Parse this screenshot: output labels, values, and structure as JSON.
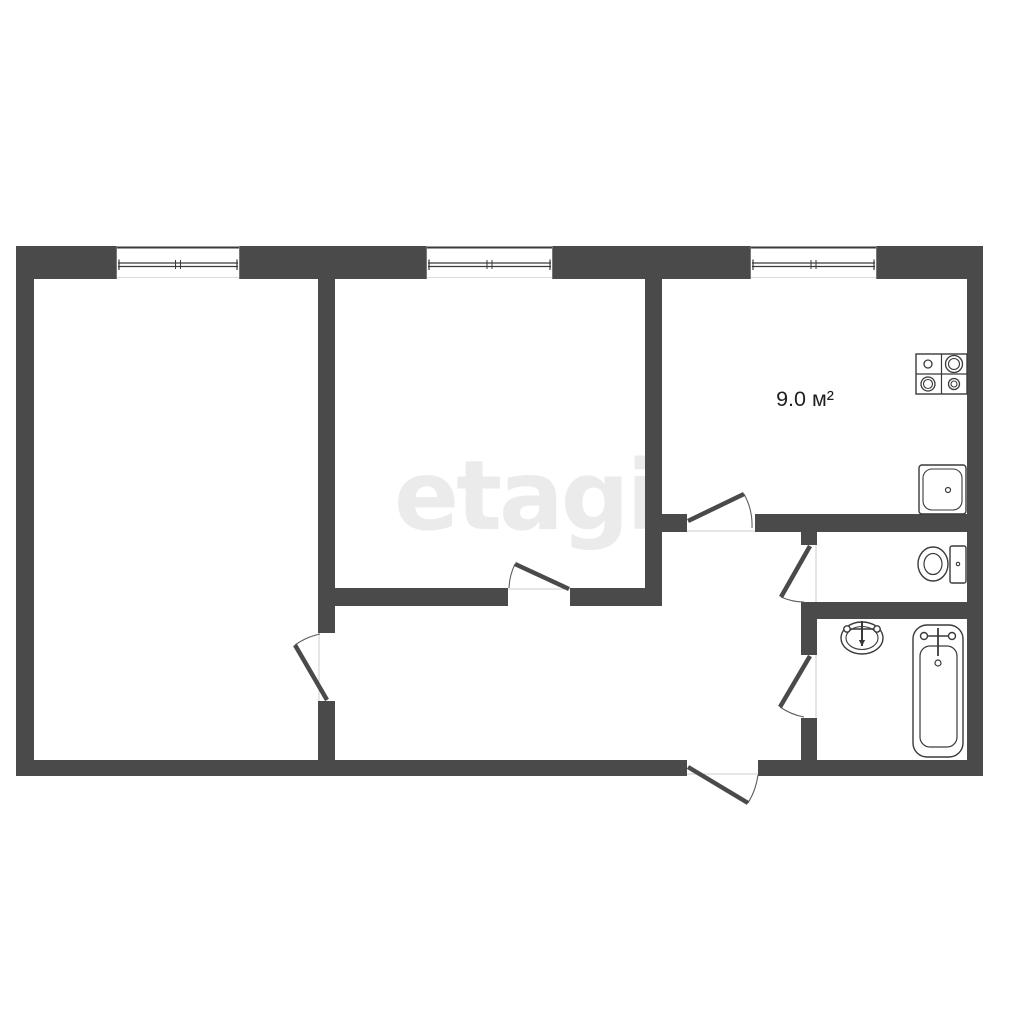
{
  "canvas": {
    "width": 1024,
    "height": 1024,
    "background": "#ffffff"
  },
  "colors": {
    "wall": "#4a4a4a",
    "door_leaf": "#4a4a4a",
    "door_arc": "#5f5f5f",
    "threshold": "#cccccc",
    "window_line": "#3a3a3a",
    "window_jamb": "#777777",
    "window_faint": "#dcdcdc",
    "fixture_stroke": "#3a3a3a",
    "fixture_fill": "#ffffff",
    "label_text": "#1f1f1f",
    "watermark": "#ebebeb"
  },
  "watermark": {
    "text": "etagi"
  },
  "labels": [
    {
      "name": "kitchen-area-label",
      "text": "9.0 м²",
      "x": 805,
      "y": 406,
      "font_size": 21.5
    }
  ],
  "walls": [
    {
      "name": "outer-top-wall-seg1",
      "x": 16,
      "y": 246,
      "w": 100,
      "h": 33
    },
    {
      "name": "outer-top-wall-seg2",
      "x": 240,
      "y": 246,
      "w": 186,
      "h": 33
    },
    {
      "name": "outer-top-wall-seg3",
      "x": 553,
      "y": 246,
      "w": 197,
      "h": 33
    },
    {
      "name": "outer-top-wall-seg4",
      "x": 877,
      "y": 246,
      "w": 106,
      "h": 33
    },
    {
      "name": "outer-left-wall",
      "x": 16,
      "y": 246,
      "w": 18,
      "h": 530
    },
    {
      "name": "outer-right-wall",
      "x": 967,
      "y": 246,
      "w": 16,
      "h": 530
    },
    {
      "name": "outer-bottom-wall-seg1",
      "x": 16,
      "y": 760,
      "w": 671,
      "h": 16
    },
    {
      "name": "outer-bottom-wall-seg2",
      "x": 758,
      "y": 760,
      "w": 225,
      "h": 16
    },
    {
      "name": "wall-left-room-right-seg1",
      "x": 318,
      "y": 279,
      "w": 17,
      "h": 354
    },
    {
      "name": "wall-left-room-right-seg2",
      "x": 318,
      "y": 701,
      "w": 17,
      "h": 59
    },
    {
      "name": "wall-middle-room-kitchen",
      "x": 645,
      "y": 279,
      "w": 17,
      "h": 327
    },
    {
      "name": "wall-middle-room-bottom-seg1",
      "x": 335,
      "y": 588,
      "w": 173,
      "h": 18
    },
    {
      "name": "wall-middle-room-bottom-seg2",
      "x": 570,
      "y": 588,
      "w": 75,
      "h": 18
    },
    {
      "name": "wall-kitchen-bottom-seg1",
      "x": 662,
      "y": 514,
      "w": 25,
      "h": 18
    },
    {
      "name": "wall-kitchen-bottom-seg2",
      "x": 755,
      "y": 514,
      "w": 212,
      "h": 18
    },
    {
      "name": "wall-sanitary-left-seg1",
      "x": 801,
      "y": 532,
      "w": 16,
      "h": 13
    },
    {
      "name": "wall-sanitary-left-seg2",
      "x": 801,
      "y": 602,
      "w": 16,
      "h": 53
    },
    {
      "name": "wall-sanitary-left-seg3",
      "x": 801,
      "y": 718,
      "w": 16,
      "h": 42
    },
    {
      "name": "wall-wc-bathroom",
      "x": 801,
      "y": 602,
      "w": 166,
      "h": 17
    }
  ],
  "windows": [
    {
      "name": "window-left-room",
      "x": 116,
      "y": 246,
      "w": 124,
      "h": 33
    },
    {
      "name": "window-middle-room",
      "x": 426,
      "y": 246,
      "w": 127,
      "h": 33
    },
    {
      "name": "window-kitchen",
      "x": 750,
      "y": 246,
      "w": 127,
      "h": 33
    }
  ],
  "doors": [
    {
      "name": "door-left-room",
      "hinge": [
        327,
        700
      ],
      "tip": [
        295,
        645
      ],
      "arc_end": [
        320,
        634
      ],
      "sweep": 1
    },
    {
      "name": "door-middle-room",
      "hinge": [
        569,
        589
      ],
      "tip": [
        515,
        564
      ],
      "arc_end": [
        509,
        588
      ],
      "sweep": 0
    },
    {
      "name": "door-kitchen",
      "hinge": [
        688,
        521
      ],
      "tip": [
        744,
        494
      ],
      "arc_end": [
        752,
        528
      ],
      "sweep": 1
    },
    {
      "name": "door-wc",
      "hinge": [
        810,
        546
      ],
      "tip": [
        781,
        597
      ],
      "arc_end": [
        804,
        602
      ],
      "sweep": 0
    },
    {
      "name": "door-bathroom",
      "hinge": [
        810,
        656
      ],
      "tip": [
        780,
        707
      ],
      "arc_end": [
        804,
        717
      ],
      "sweep": 0
    },
    {
      "name": "door-entrance",
      "hinge": [
        688,
        767
      ],
      "tip": [
        748,
        803
      ],
      "arc_end": [
        758,
        775
      ],
      "sweep": 0
    }
  ],
  "thresholds": [
    {
      "name": "threshold-left-room",
      "x1": 319,
      "y1": 633,
      "x2": 319,
      "y2": 701
    },
    {
      "name": "threshold-middle-room",
      "x1": 508,
      "y1": 589,
      "x2": 570,
      "y2": 589
    },
    {
      "name": "threshold-kitchen",
      "x1": 687,
      "y1": 531,
      "x2": 755,
      "y2": 531
    },
    {
      "name": "threshold-wc",
      "x1": 816,
      "y1": 545,
      "x2": 816,
      "y2": 602
    },
    {
      "name": "threshold-bathroom",
      "x1": 816,
      "y1": 655,
      "x2": 816,
      "y2": 718
    },
    {
      "name": "threshold-entrance",
      "x1": 687,
      "y1": 774,
      "x2": 758,
      "y2": 774
    }
  ],
  "fixtures": {
    "stove": {
      "name": "stove-icon",
      "x": 916,
      "y": 354,
      "w": 51,
      "h": 40,
      "burners": [
        {
          "cx": 928,
          "cy": 364,
          "r": 4
        },
        {
          "cx": 954,
          "cy": 364,
          "r": 8.5,
          "r2": 5.5
        },
        {
          "cx": 928,
          "cy": 384,
          "r": 7,
          "r2": 4.5
        },
        {
          "cx": 954,
          "cy": 384,
          "r": 5.5,
          "r2": 3
        }
      ]
    },
    "kitchen_sink": {
      "name": "kitchen-sink-icon",
      "x": 919,
      "y": 465,
      "w": 47,
      "h": 49,
      "inner_inset": 4,
      "inner_rx": 9,
      "drain": {
        "cx": 948,
        "cy": 490,
        "r": 2.5
      }
    },
    "toilet": {
      "name": "toilet-icon",
      "tank": {
        "x": 950,
        "y": 546,
        "w": 16,
        "h": 37
      },
      "bowl": {
        "cx": 933,
        "cy": 564,
        "rx": 15,
        "ry": 17
      },
      "bowl_inner": {
        "rx": 9,
        "ry": 10.5
      },
      "tank_dot": {
        "cx": 958,
        "cy": 564,
        "r": 1.7
      }
    },
    "wash_basin": {
      "name": "wash-basin-icon",
      "cx": 862,
      "cy": 638,
      "rx": 21,
      "ry": 16,
      "inner_rx": 16,
      "inner_ry": 11.5,
      "faucet": {
        "bar_y": 629,
        "bar_x1": 847,
        "bar_x2": 877,
        "end_r": 3.2,
        "stem_x": 862,
        "stem_top": 621,
        "stem_bottom": 646
      }
    },
    "bathtub": {
      "name": "bathtub-icon",
      "x": 913,
      "y": 625,
      "w": 50,
      "h": 132,
      "rx": 14,
      "inner": {
        "x": 920,
        "y": 646,
        "w": 37,
        "h": 101,
        "rx": 10
      },
      "faucet": {
        "cx": 938,
        "stem_top": 628,
        "stem_bottom": 656,
        "bar_y": 636,
        "bar_x1": 924,
        "bar_x2": 952,
        "end_r": 3.5
      },
      "drain": {
        "cx": 938,
        "cy": 663,
        "r": 3
      }
    }
  }
}
